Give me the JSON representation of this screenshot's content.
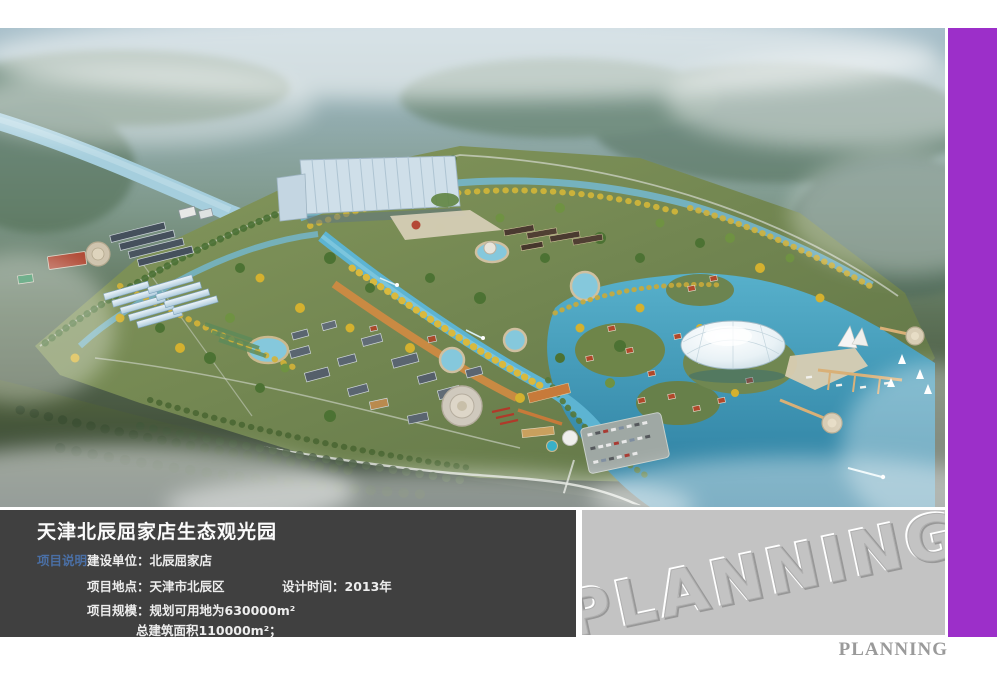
{
  "info_panel": {
    "title": "天津北辰屈家店生态观光园",
    "section_label": "项目说明",
    "builder": {
      "label": "建设单位：",
      "value": "北辰屈家店"
    },
    "location": {
      "label": "项目地点：",
      "value": "天津市北辰区"
    },
    "design_time": {
      "label": "设计时间：",
      "value": "2013年"
    },
    "scale": {
      "label": "项目规模：",
      "value": "规划可用地为630000m²"
    },
    "floor_area": {
      "value": "总建筑面积110000m²；"
    }
  },
  "watermark": {
    "text": "PLANNING"
  },
  "footer": {
    "text": "PLANNING"
  },
  "colors": {
    "accent_purple": "#9c2fc9",
    "panel_dark": "#404040",
    "watermark_bg": "#c3c3c3",
    "section_label_blue": "#4a6fa5",
    "footer_gray": "#9a9a9a",
    "lake_teal": "#2c7fa0",
    "park_green": "#647a47",
    "canal_blue": "#5db4d2",
    "beach_orange": "#cd8a42"
  }
}
